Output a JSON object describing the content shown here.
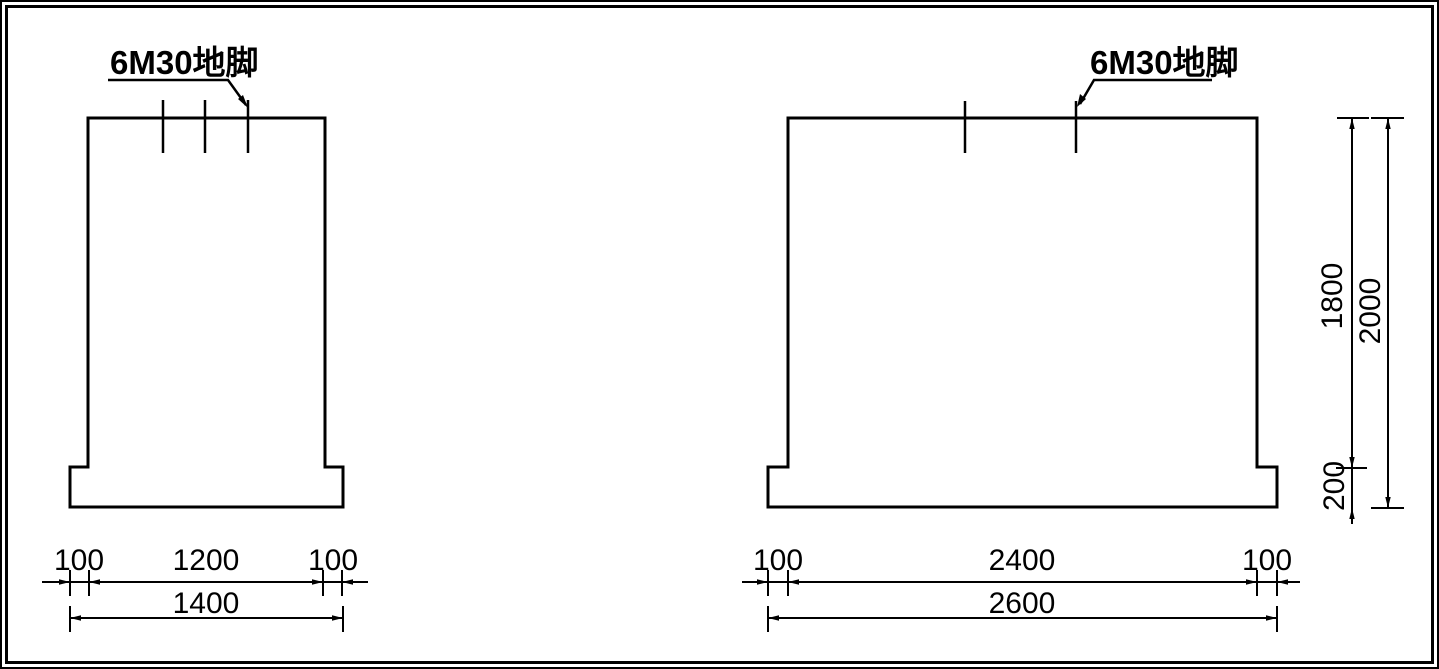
{
  "canvas": {
    "background": "#ffffff",
    "line_color": "#000000"
  },
  "views": {
    "left": {
      "name": "small-pedestal-elevation",
      "anchor_label": "6M30地脚",
      "anchor_bolt_count": 3,
      "dims": {
        "bottom_row1": [
          "100",
          "1200",
          "100"
        ],
        "bottom_row2": "1400"
      }
    },
    "right": {
      "name": "large-pedestal-elevation",
      "anchor_label": "6M30地脚",
      "anchor_bolt_count": 2,
      "dims": {
        "bottom_row1": [
          "100",
          "2400",
          "100"
        ],
        "bottom_row2": "2600",
        "side_body_height": "1800",
        "side_total_height": "2000",
        "side_footing_height": "200"
      }
    }
  }
}
